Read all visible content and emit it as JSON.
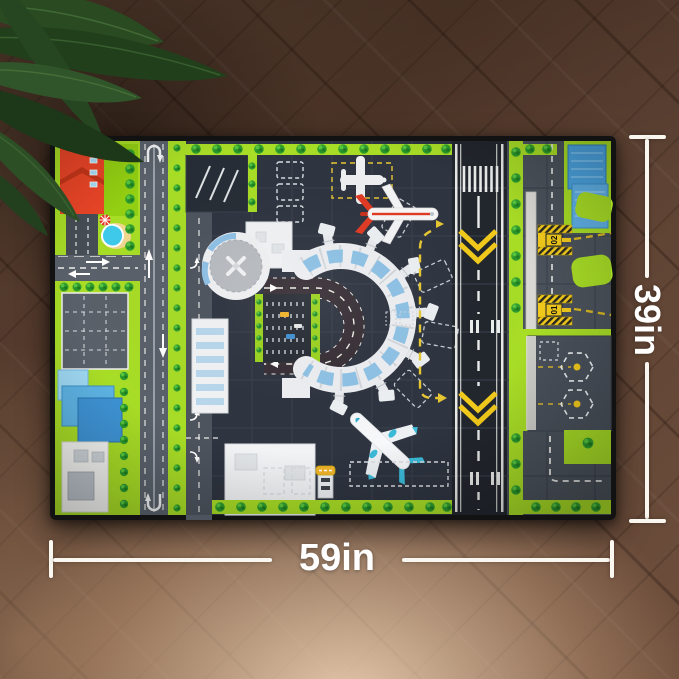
{
  "dimensions": {
    "width_label": "59in",
    "height_label": "39in"
  },
  "mat": {
    "holding_signs": [
      "02",
      "01"
    ]
  },
  "colors": {
    "floor_dark": "#53392b",
    "floor_light": "#c7a384",
    "mat_green": "#a8dd26",
    "tarmac": "#2e3440",
    "runway": "#22262d",
    "accent_yellow": "#f2ca1c",
    "terminal_white": "#f0f1f3",
    "pool_blue": "#3ec9ea",
    "roof_red": "#e8472a",
    "building_blue": "#4ba2de",
    "plane_teal": "#3bbbd9",
    "dimension_white": "#faf7f1"
  }
}
